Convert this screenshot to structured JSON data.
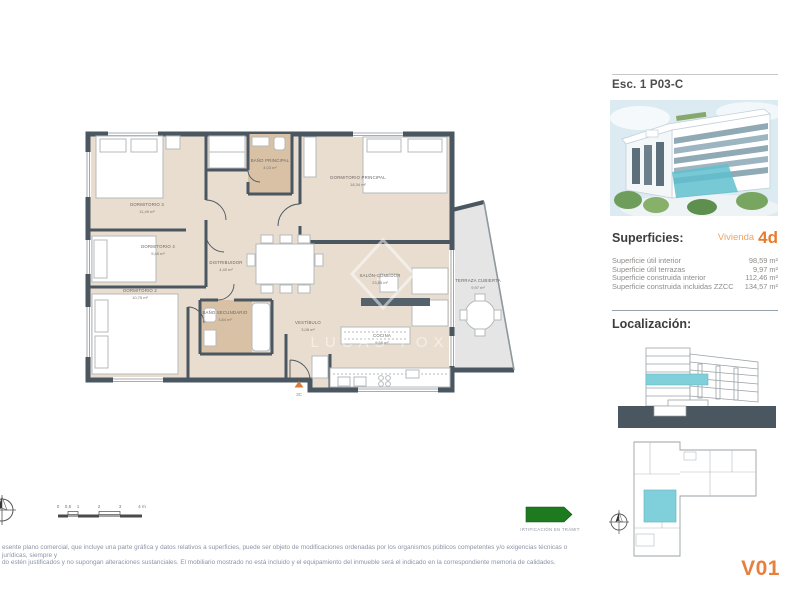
{
  "header": {
    "plan_ref": "Esc. 1 P03-C"
  },
  "superficies": {
    "heading": "Superficies:",
    "vivienda_label": "Vivienda",
    "vivienda_value": "4d",
    "rows": [
      {
        "label": "Superficie útil interior",
        "value": "98,59 m²"
      },
      {
        "label": "Superficie útil terrazas",
        "value": "9,97 m²"
      },
      {
        "label": "Superficie construida interior",
        "value": "112,46 m²"
      },
      {
        "label": "Superficie construida incluidas ZZCC",
        "value": "134,57 m²"
      }
    ]
  },
  "localizacion": {
    "heading": "Localización:"
  },
  "floorplan": {
    "watermark": "LUCAS FOX",
    "entrance_label": "3C",
    "rooms": [
      {
        "name": "DORMITORIO 3",
        "area": "11,49 m²"
      },
      {
        "name": "BAÑO PRINCIPAL",
        "area": "4,03 m²"
      },
      {
        "name": "DORMITORIO PRINCIPAL",
        "area": "18,34 m²"
      },
      {
        "name": "DORMITORIO 4",
        "area": "9,46 m²"
      },
      {
        "name": "DISTRIBUIDOR",
        "area": "4,40 m²"
      },
      {
        "name": "DORMITORIO 2",
        "area": "10,75 m²"
      },
      {
        "name": "BAÑO SECUNDARIO",
        "area": "3,84 m²"
      },
      {
        "name": "VESTÍBULO",
        "area": "3,08 m²"
      },
      {
        "name": "SALÓN-COMEDOR",
        "area": "23,65 m²"
      },
      {
        "name": "COCINA",
        "area": "9,55 m²"
      },
      {
        "name": "TERRAZA CUBIERTA",
        "area": "9,97 m²"
      }
    ]
  },
  "scale_bar": {
    "ticks": [
      "0",
      "0,5",
      "1",
      "2",
      "3",
      "4 m"
    ]
  },
  "certification": {
    "label": "CERTIFICACIÓN EN TRÁMITE"
  },
  "footer": {
    "disclaimer_line1": "esente plano comercial, que incluye una parte gráfica y datos relativos a superficies, puede ser objeto de modificaciones ordenadas por los organismos públicos competentes y/o exigencias técnicas o jurídicas, siempre y",
    "disclaimer_line2": "do estén justificados y no supongan alteraciones sustanciales. El mobiliario mostrado no está incluido y el equipamiento del inmueble será el indicado en la correspondiente memoria de calidades.",
    "version": "V01"
  },
  "colors": {
    "wall": "#4a5761",
    "floor": "#e9ddd0",
    "bath_floor": "#d9c1a6",
    "terrace_floor": "#e4e5e4",
    "highlight_cyan": "#7fd0da",
    "accent_orange": "#e87c2e",
    "green_arrow": "#1d7a1f"
  }
}
